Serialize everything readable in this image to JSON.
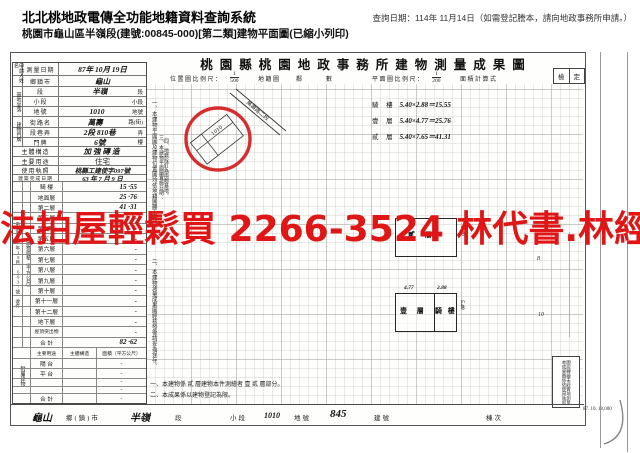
{
  "colors": {
    "overlay_red": "#e01515",
    "circle_red": "#d11c1c",
    "grid_gray": "#96948a"
  },
  "header": {
    "system_title": "北北桃地政電傳全功能地籍資料查詢系統",
    "query_date": "查詢日期：114年 11月14日（如需登記謄本，請向地政事務所申請。）",
    "document_line": "桃園市龜山區半嶺段(建號:00845-000)[第二類]建物平面圖(已縮小列印)"
  },
  "overlay": {
    "ad_text": "法拍屋輕鬆買 2266-3524 林代書.林經理"
  },
  "form": {
    "title": "桃園縣桃園地政事務所建物測量成果圖",
    "scale_bar": {
      "location_scale_label": "位置圖比例尺：",
      "location_num": "1",
      "location_den": "500",
      "cadastre_label": "地籍圖",
      "lin_label": "鄰",
      "count_label": "數",
      "plan_scale_label": "平面圖比例尺：",
      "plan_num": "1",
      "plan_den": "200",
      "area_calc_label": "面積計算式",
      "check_cells": [
        "檢",
        "定"
      ]
    },
    "table": {
      "applicant_label": "申請人姓名",
      "site_block_label": "基地坐落",
      "door_block_label": "建物門牌",
      "rows_top": [
        {
          "label": "測量日期",
          "value": "87年 10月 19日",
          "suffix": ""
        },
        {
          "label": "鄉鎮市",
          "value": "龜山",
          "suffix": ""
        },
        {
          "label": "段",
          "value": "半嶺",
          "suffix": "段"
        },
        {
          "label": "小段",
          "value": "",
          "suffix": "小段"
        },
        {
          "label": "地號",
          "value": "1010",
          "suffix": "地號"
        },
        {
          "label": "街路名",
          "value": "萬壽",
          "suffix": "路(街)"
        },
        {
          "label": "段巷弄",
          "value": "2段 810巷",
          "suffix": "弄"
        },
        {
          "label": "門牌",
          "value": "6號",
          "suffix": "樓"
        },
        {
          "label": "主體構造",
          "value": "加強磚造",
          "suffix": ""
        },
        {
          "label": "主要用途",
          "value": "住宅",
          "suffix": ""
        },
        {
          "label": "使用執照",
          "value": "桃縣工建使字097號",
          "suffix": ""
        },
        {
          "label": "建築完成日期",
          "value": "63 年 7 月 9 日",
          "suffix": ""
        }
      ],
      "area_block_label": "建物面積（平方公尺）",
      "margin_note": "申請書87年10月 6037號 收件",
      "area_rows": [
        {
          "label": "騎 樓",
          "value": "15 ·55"
        },
        {
          "label": "地面層",
          "value": "25 ·76"
        },
        {
          "label": "第二層",
          "value": "41 ·31"
        },
        {
          "label": "第三層",
          "value": "-"
        },
        {
          "label": "第四層",
          "value": "-"
        },
        {
          "label": "第五層",
          "value": "-"
        },
        {
          "label": "第六層",
          "value": "-"
        },
        {
          "label": "第七層",
          "value": "-"
        },
        {
          "label": "第八層",
          "value": "-"
        },
        {
          "label": "第九層",
          "value": "-"
        },
        {
          "label": "第十層",
          "value": "-"
        },
        {
          "label": "第十一層",
          "value": "-"
        },
        {
          "label": "第十二層",
          "value": "-"
        },
        {
          "label": "地下層",
          "value": "-"
        },
        {
          "label": "屋頂突出物",
          "value": "-"
        },
        {
          "label": "合 計",
          "value": "82 ·62"
        }
      ],
      "annex_block_label": "附屬建物",
      "annex_header": {
        "use": "主要用途",
        "struct": "主體構造",
        "area": "面積（平方公尺）"
      },
      "annex_rows": [
        {
          "use": "陽 台",
          "struct": "",
          "area": "-"
        },
        {
          "use": "平 台",
          "struct": "",
          "area": "-"
        },
        {
          "use": "",
          "struct": "",
          "area": "-"
        },
        {
          "use": "",
          "struct": "",
          "area": "-"
        },
        {
          "use": "合 計",
          "struct": "",
          "area": "-"
        }
      ]
    },
    "side_notes": [
      "一、本建物平面圖及建物位置圖均依地籍圖謄本轉繪。",
      "二、本建物測量成果圖經核發後請妥為保存。",
      "三、本建物平面圖實施日期：",
      "四、地籍拴釘為兩鄰基地。"
    ],
    "drawing": {
      "calc_lines": [
        {
          "label": "騎 樓",
          "formula": "5.40×2.88＝15.55"
        },
        {
          "label": "壹 層",
          "formula": "5.40×4.77＝25.76"
        },
        {
          "label": "貳 層",
          "formula": "5.40×7.65＝41.31"
        }
      ],
      "second_floor_label": "貳 層",
      "first_floor_label": "壹 層",
      "arcade_label": "騎 樓",
      "dim_first": "4.77",
      "dim_arcade": "2.88",
      "dim_depth_first": "5.40",
      "dim_depth_second": "5.40",
      "road_label": "萬壽路二段",
      "parcel_label": "1010",
      "grid_ref_a": "8",
      "grid_ref_b": "10",
      "stamp_lines": [
        "本成果圖係依使用執照",
        "圖說轉繪未經實地測量"
      ]
    },
    "notes": [
      "一、本建物係 貳 層建物本件測繪者 壹 貳 層部分。",
      "二、本成果係以建物登記為限。"
    ],
    "bottom_bar": {
      "town_value": "龜山",
      "town_label": "鄉(鎮)市",
      "section_value": "半嶺",
      "section_label": "段",
      "subsection_label": "小段",
      "parcel_value": "1010",
      "parcel_label": "地號",
      "building_value": "845",
      "building_label": "建號",
      "unit_label": "棟次"
    },
    "print_code": "87. 10. 18,000"
  }
}
